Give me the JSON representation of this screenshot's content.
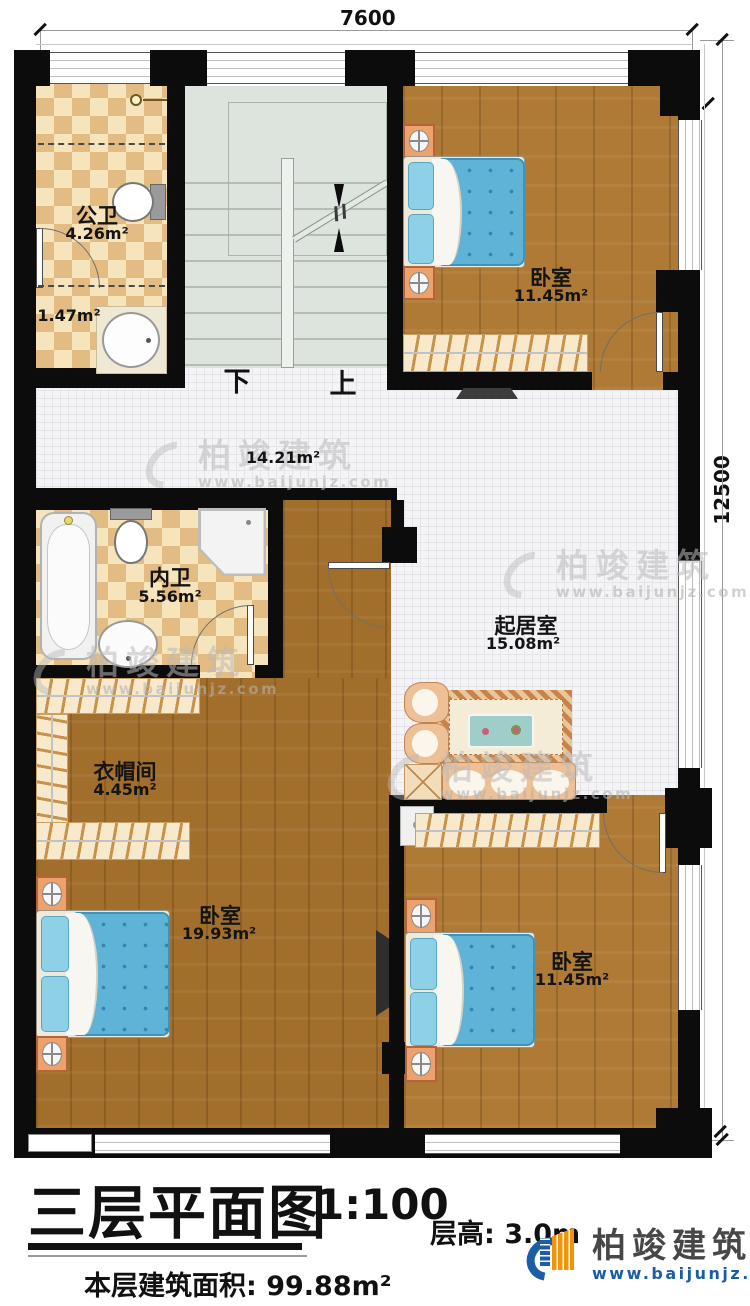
{
  "dimensions": {
    "top": "7600",
    "right": "12500"
  },
  "stairs": {
    "down": "下",
    "up": "上"
  },
  "rooms": {
    "public_bath": {
      "name": "公卫",
      "area": "4.26m²"
    },
    "bath_anteroom": {
      "area": "1.47m²"
    },
    "hall": {
      "area": "14.21m²"
    },
    "bedroom_top": {
      "name": "卧室",
      "area": "11.45m²"
    },
    "inner_bath": {
      "name": "内卫",
      "area": "5.56m²"
    },
    "living_room": {
      "name": "起居室",
      "area": "15.08m²"
    },
    "cloakroom": {
      "name": "衣帽间",
      "area": "4.45m²"
    },
    "bedroom_left": {
      "name": "卧室",
      "area": "19.93m²"
    },
    "bedroom_right": {
      "name": "卧室",
      "area": "11.45m²"
    }
  },
  "title_block": {
    "title": "三层平面图",
    "scale": "1:100",
    "floor_height": "层高: 3.0m",
    "floor_area": "本层建筑面积: 99.88m²"
  },
  "brand": {
    "name": "柏竣建筑",
    "url": "www.baijunjz.com"
  },
  "colors": {
    "wall": "#0c0c0c",
    "wood": "#ae7a35",
    "bed_blue": "#5fb3d6",
    "logo_blue": "#1b5ea6",
    "logo_orange": "#f0940c"
  }
}
